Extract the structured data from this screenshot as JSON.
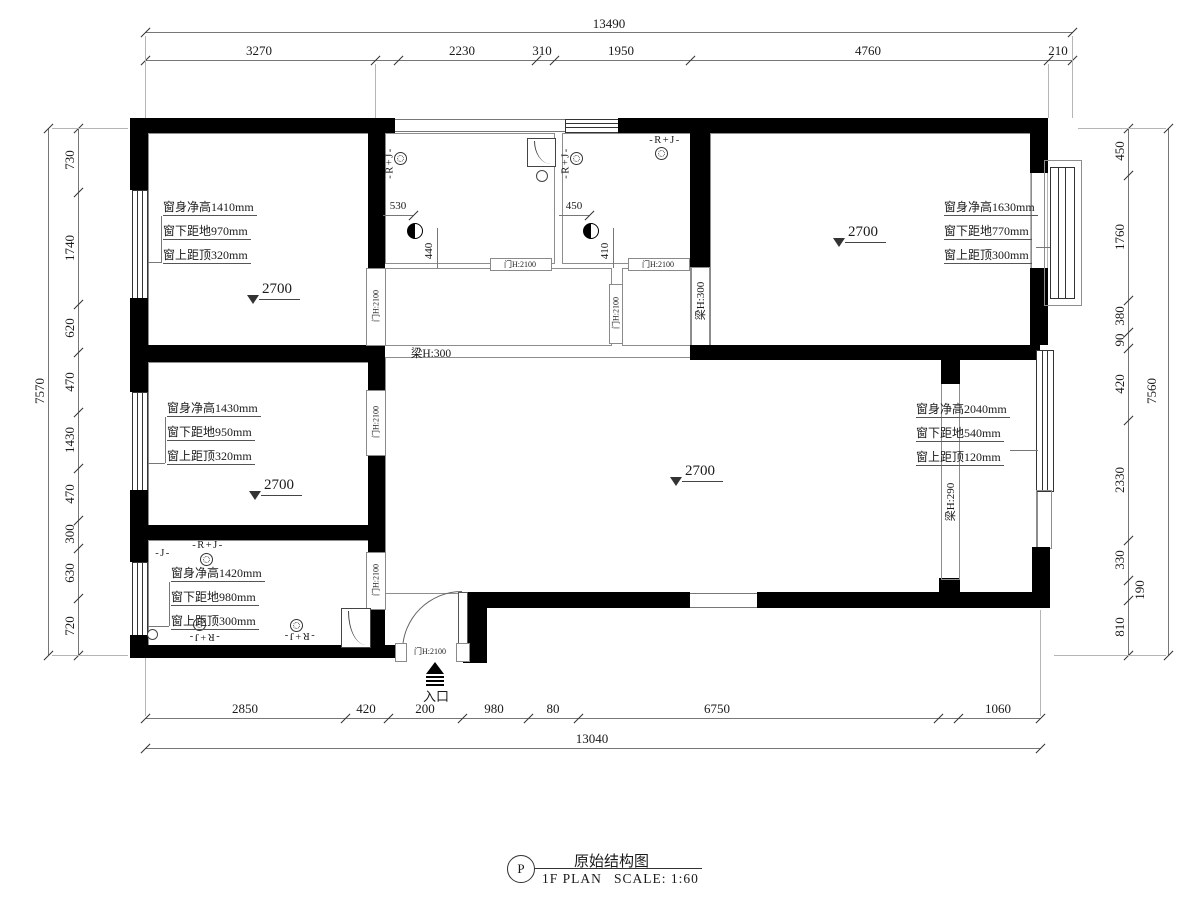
{
  "title_block": {
    "bubble": "P",
    "title": "原始结构图",
    "plan": "1F PLAN",
    "scale": "SCALE: 1:60"
  },
  "entrance": {
    "label": "入口"
  },
  "doors": {
    "label": "门H:2100"
  },
  "beams": {
    "b300": "梁H:300",
    "b290": "梁H:290"
  },
  "fixtures": {
    "rj": "-R+J-",
    "j": "-J-"
  },
  "levels": {
    "value": "2700"
  },
  "bath_dims": {
    "b1_w": "530",
    "b1_h": "440",
    "b2_w": "450",
    "b2_h": "410"
  },
  "specs": {
    "top_left": [
      "窗身净高1410mm",
      "窗下距地970mm",
      "窗上距顶320mm"
    ],
    "top_right": [
      "窗身净高1630mm",
      "窗下距地770mm",
      "窗上距顶300mm"
    ],
    "mid_left": [
      "窗身净高1430mm",
      "窗下距地950mm",
      "窗上距顶320mm"
    ],
    "right": [
      "窗身净高2040mm",
      "窗下距地540mm",
      "窗上距顶120mm"
    ],
    "bottom_left": [
      "窗身净高1420mm",
      "窗下距地980mm",
      "窗上距顶300mm"
    ]
  },
  "dims": {
    "top": {
      "overall": "13490",
      "segments": [
        "3270",
        "2230",
        "310",
        "1950",
        "4760",
        "210"
      ]
    },
    "bottom": {
      "overall": "13040",
      "segments": [
        "2850",
        "420",
        "200",
        "980",
        "80",
        "6750",
        "1060"
      ]
    },
    "left": {
      "overall": "7570",
      "segments": [
        "730",
        "1740",
        "620",
        "470",
        "1430",
        "470",
        "300",
        "630",
        "720"
      ]
    },
    "right": {
      "overall": "7560",
      "segments": [
        "450",
        "1760",
        "380",
        "90",
        "420",
        "2330",
        "330",
        "190",
        "810"
      ]
    }
  }
}
